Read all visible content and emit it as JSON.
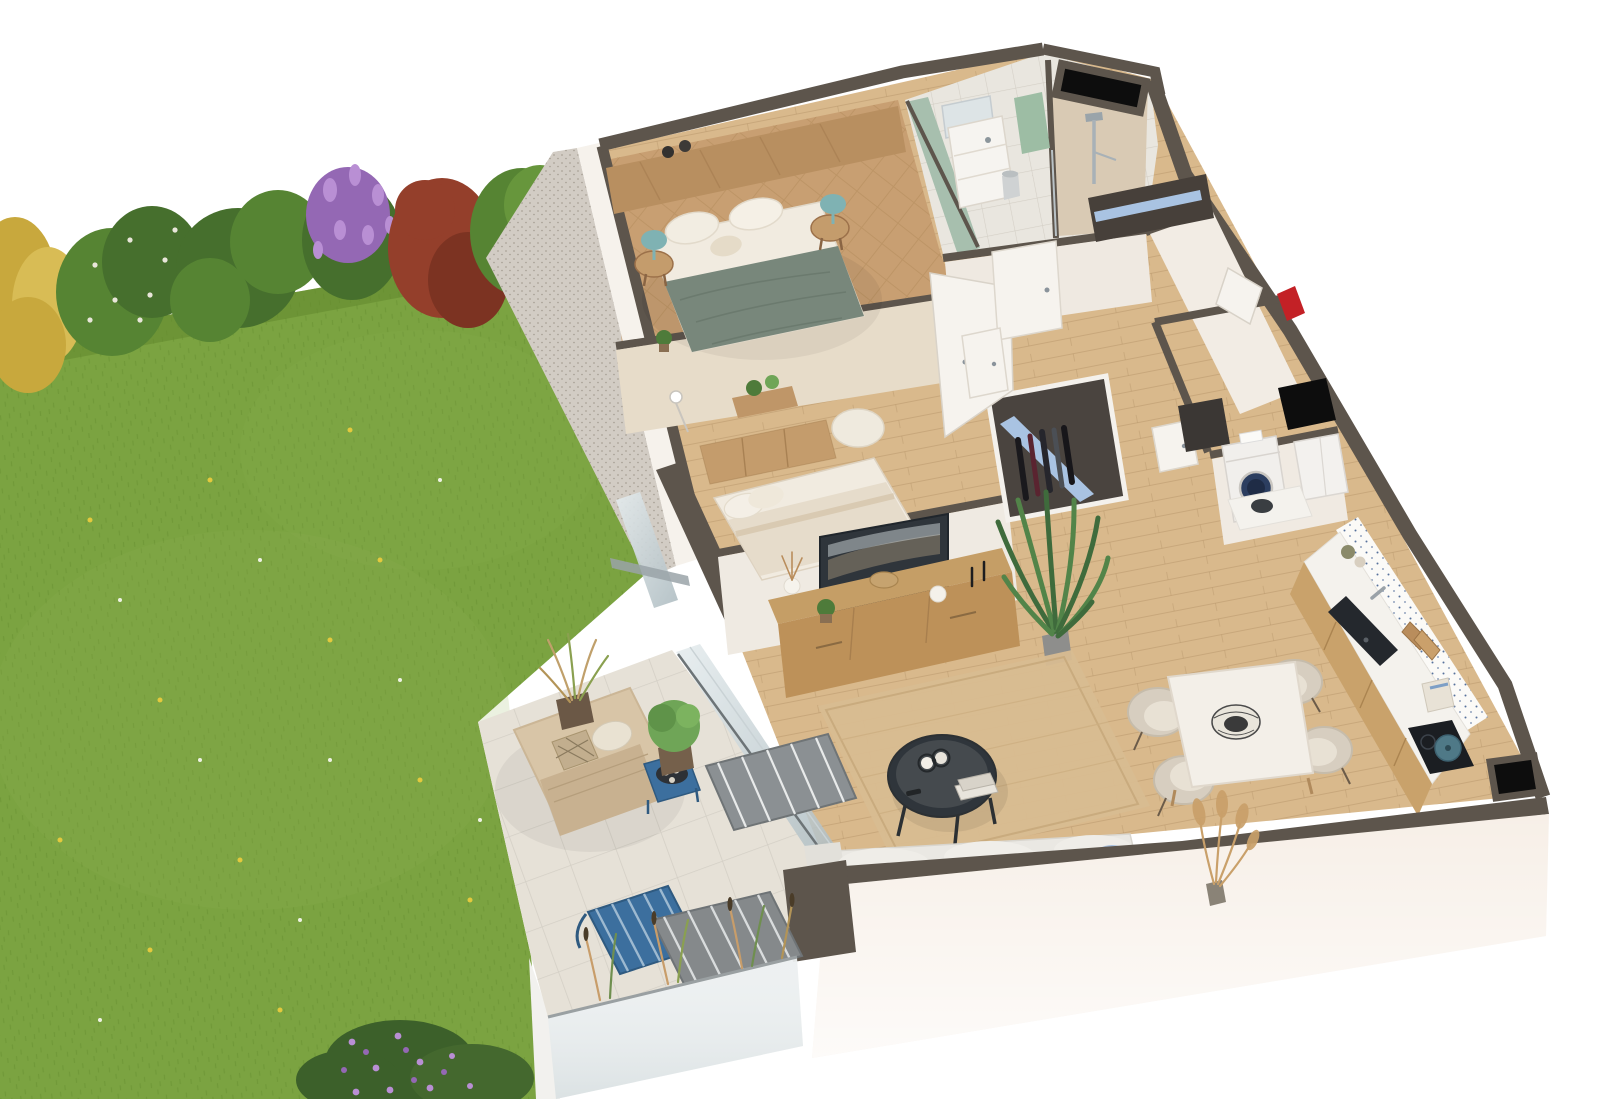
{
  "scene": {
    "type": "3d-apartment-floorplan-render",
    "style": "isometric cutaway dollhouse view of a garden-level apartment",
    "width": 1600,
    "height": 1099,
    "background": "#ffffff"
  },
  "palette": {
    "bg": "#ffffff",
    "lawn": "#7ba341",
    "lawn_shadow": "#63882e",
    "lawn_light": "#8fb452",
    "hedge_green_dark": "#466f2d",
    "hedge_green": "#568433",
    "hedge_yellow": "#c8a83d",
    "hedge_yellow_light": "#d8bc55",
    "hedge_purple": "#9468b4",
    "hedge_purple_light": "#b98fd4",
    "hedge_red": "#943f2b",
    "hedge_red_dark": "#7c3322",
    "gravel": "#d2ccc4",
    "wall_cut": "#5d554c",
    "wall_face": "#f6f2ec",
    "wall_south_face": "#f7efe7",
    "wallpaper": "#e7dcc9",
    "sage_wall": "#a7bfae",
    "wood_floor": "#d9b98c",
    "parquet": "#c89f72",
    "tile_bath": "#e9e6df",
    "shower_beige": "#d9cab4",
    "terrace_tile": "#e6e1d7",
    "frosted_glass": "#e9edee",
    "glass": "#c2ced2",
    "daybed": "#d8c5a7",
    "blanket": "#c8b190",
    "blue_metal": "#3c6f9e",
    "gray_metal": "#8b9093",
    "duvet_green": "#78877b",
    "linen": "#f1ebe0",
    "teal_lamp": "#7fb2b3",
    "headboard_wood": "#b88f60",
    "furniture_wood": "#c49c6c",
    "sideboard_wood": "#c59e66",
    "tv_dark": "#2f353b",
    "rug_jute": "#d8bc91",
    "sofa": "#eae8e3",
    "pillow_blue": "#9db7d8",
    "chair_cream": "#d7cec0",
    "table_white": "#f3efe8",
    "counter": "#f4f2ed",
    "kitchen_wood": "#c9a26b",
    "sink_black": "#24282d",
    "washer_blue": "#2c3e60",
    "shelf_blue": "#a9c3e2",
    "towel_green": "#9dbda4",
    "plant_green": "#4e7b3a",
    "plant_light": "#6fa557",
    "pampas_tan": "#c9a06a",
    "red_marker": "#c32126",
    "duct_black": "#0d0d0d",
    "door_white": "#f6f3ee"
  },
  "garden": {
    "lawn": "grass lawn with scattered dandelions and daisies",
    "hedge_shrubs": [
      "yellow shrub",
      "green shrub with white blossom",
      "green shrub",
      "purple lilac shrub",
      "red-leaf shrub",
      "green tree"
    ],
    "flower_patch": "purple flowering shrub patch",
    "gravel_strip": "gravel drainage strip along facade"
  },
  "terrace": {
    "floor": "pale stone tile patio",
    "items": [
      "beige lounge daybed with blanket and pillows",
      "blue metal side table with serving tray and cups",
      "gray slatted lounge chair",
      "blue slatted lounge chair",
      "second gray slatted lounge chair",
      "potted ornamental grass",
      "potted green grass",
      "ornamental grasses along screen",
      "frosted glass privacy screen"
    ]
  },
  "apartment": {
    "walls": {
      "cut_color": "#5d554c",
      "face_color": "#f6f2ec"
    },
    "utility_markers": [
      "black ventilation shaft north-east",
      "black duct at laundry",
      "black duct at south-east corner",
      "red entrance marker on east wall"
    ],
    "rooms": [
      {
        "id": "master-bedroom",
        "floor": "diagonal oak parquet",
        "items": [
          "double bed with sage green duvet",
          "white pillows",
          "wood headboard panel with shelf",
          "pair of dark candle jars",
          "round bedside table left",
          "round bedside table right",
          "teal table lamp left",
          "teal table lamp right",
          "potted plant",
          "open white door"
        ]
      },
      {
        "id": "bathroom",
        "floor": "ceramic tile",
        "items": [
          "white vanity unit with washbasin",
          "mirror",
          "sage green towel",
          "waste bin",
          "sage green accent wall"
        ]
      },
      {
        "id": "shower-room",
        "items": [
          "walk-in shower with beige tiling",
          "chrome shower column",
          "glass screen"
        ]
      },
      {
        "id": "hallway",
        "floor": "oak planks",
        "items": [
          "wardrobe with hanging clothes and blue shelf",
          "entry closet with blue shelf",
          "white interior doors",
          "entrance door"
        ]
      },
      {
        "id": "laundry-room",
        "items": [
          "washing machine with navy porthole door",
          "white storage cabinet",
          "dark storage nook"
        ]
      },
      {
        "id": "second-bedroom",
        "floor": "oak planks",
        "items": [
          "double bed with white and beige bedding",
          "wood dresser",
          "white pouf",
          "arc floor lamp",
          "console with plants",
          "glazed bay window"
        ]
      },
      {
        "id": "living-room",
        "floor": "oak planks",
        "items": [
          "wall-mounted TV",
          "long wood TV sideboard",
          "dried flower vase",
          "potted plant",
          "decor bowl and candlesticks",
          "potted palm",
          "jute rug",
          "round black coffee table with candles and books",
          "white sofa with blue cushions",
          "pampas grass arrangement"
        ]
      },
      {
        "id": "dining-area",
        "items": [
          "white dining table with wood legs",
          "four cream shell chairs",
          "dark wire basket centerpiece"
        ]
      },
      {
        "id": "kitchen",
        "items": [
          "oak base cabinets with white countertop",
          "black sink with mixer tap",
          "cutting boards",
          "toaster",
          "induction hob with teal casserole",
          "patterned tile backsplash",
          "decor jars",
          "dark bowl on counter return"
        ]
      }
    ]
  }
}
